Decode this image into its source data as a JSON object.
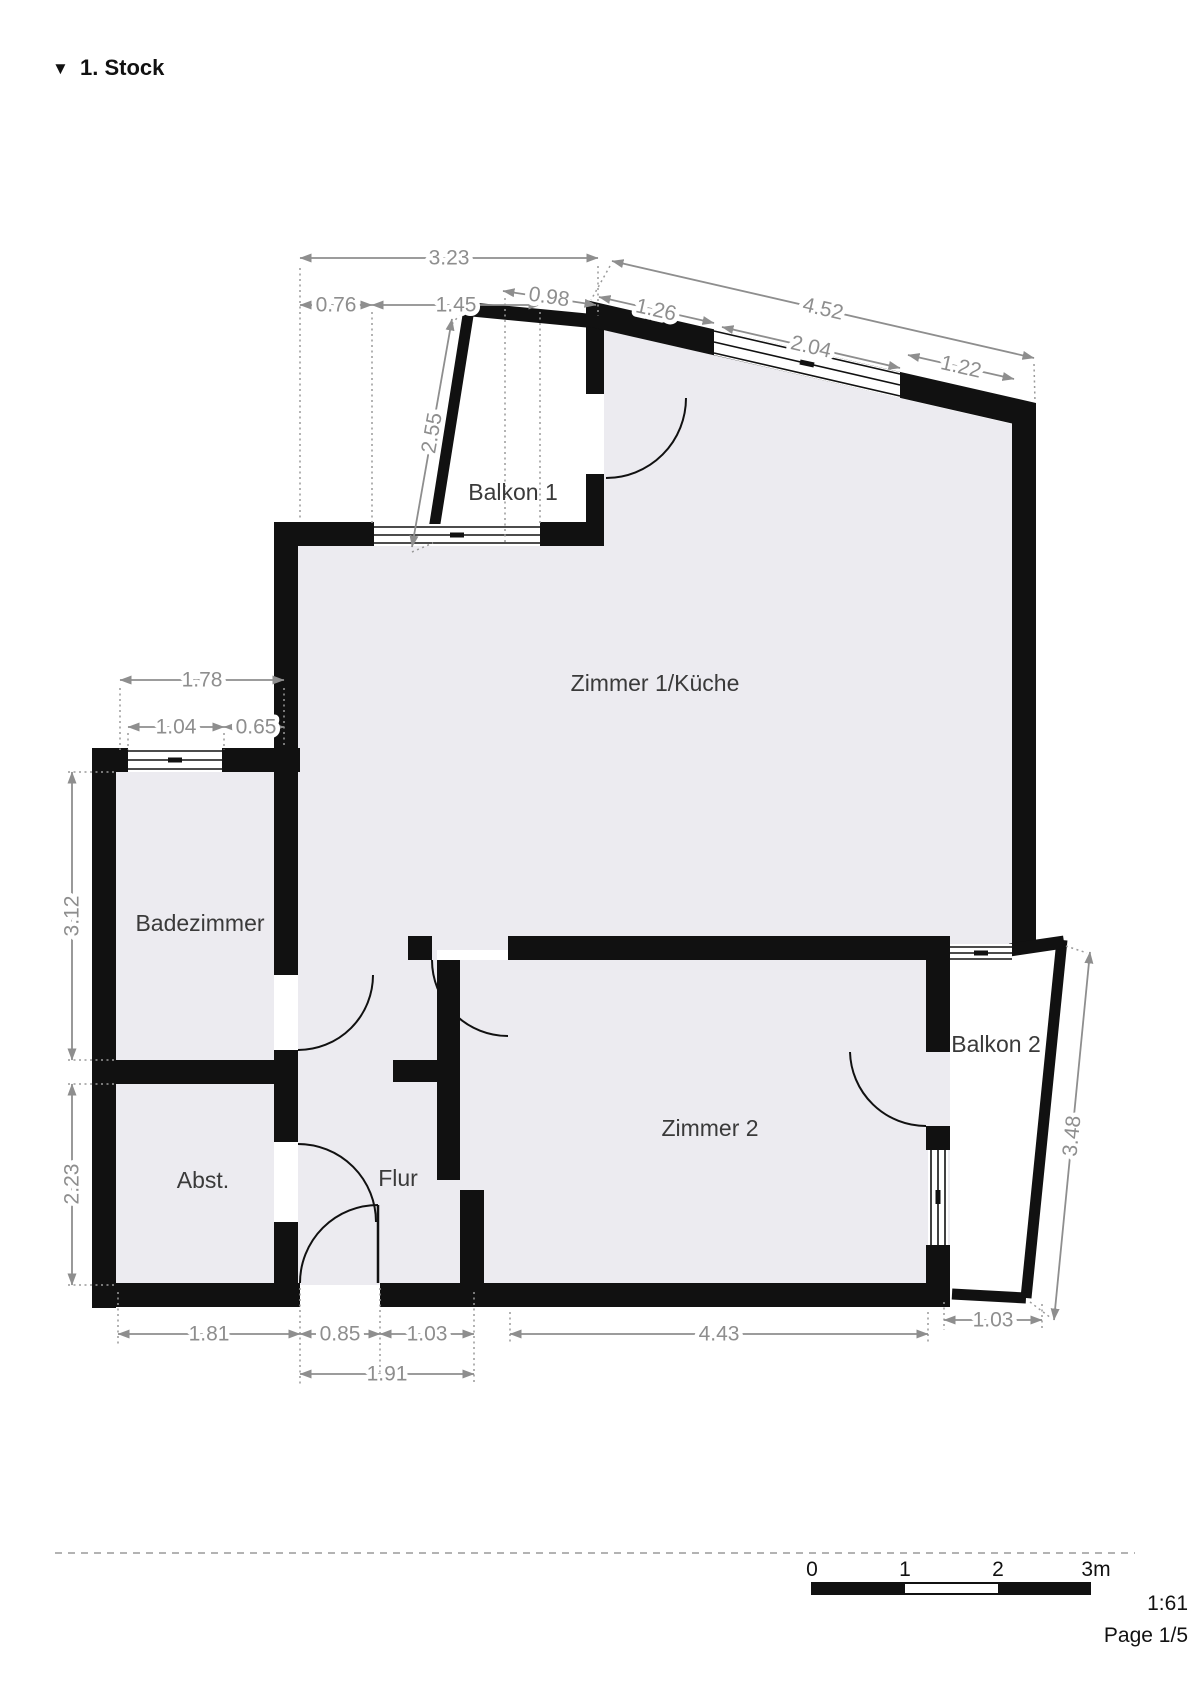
{
  "title": {
    "icon": "▼",
    "text": "1. Stock"
  },
  "rooms": {
    "balkon1": "Balkon 1",
    "zimmer1_kueche": "Zimmer 1/Küche",
    "badezimmer": "Badezimmer",
    "abstellraum": "Abst.",
    "flur": "Flur",
    "zimmer2": "Zimmer 2",
    "balkon2": "Balkon 2"
  },
  "dimensions_m": {
    "top_total": "3.23",
    "top_left": "0.76",
    "top_window": "1.45",
    "balkon1_top": "0.98",
    "roof_total": "4.52",
    "roof_left": "1.26",
    "roof_window": "2.04",
    "roof_right": "1.22",
    "balkon1_side": "2.55",
    "bad_top_total": "1.78",
    "bad_window": "1.04",
    "bad_top_right": "0.65",
    "bad_height": "3.12",
    "abst_height": "2.23",
    "bottom_abst": "1.81",
    "bottom_entry": "0.85",
    "bottom_flur": "1.03",
    "bottom_entry_total": "1.91",
    "bottom_zimmer2": "4.43",
    "bottom_balkon2": "1.03",
    "balkon2_side": "3.48"
  },
  "footer": {
    "scale_ticks": [
      "0",
      "1",
      "2",
      "3m"
    ],
    "scale_ratio": "1:61",
    "page": "Page 1/5"
  },
  "colors": {
    "wall": "#111111",
    "room_fill": "#ECEBF0",
    "balcony_fill": "#FFFFFF",
    "dimension": "#8E8E8E",
    "room_label": "#3A3A3A"
  }
}
